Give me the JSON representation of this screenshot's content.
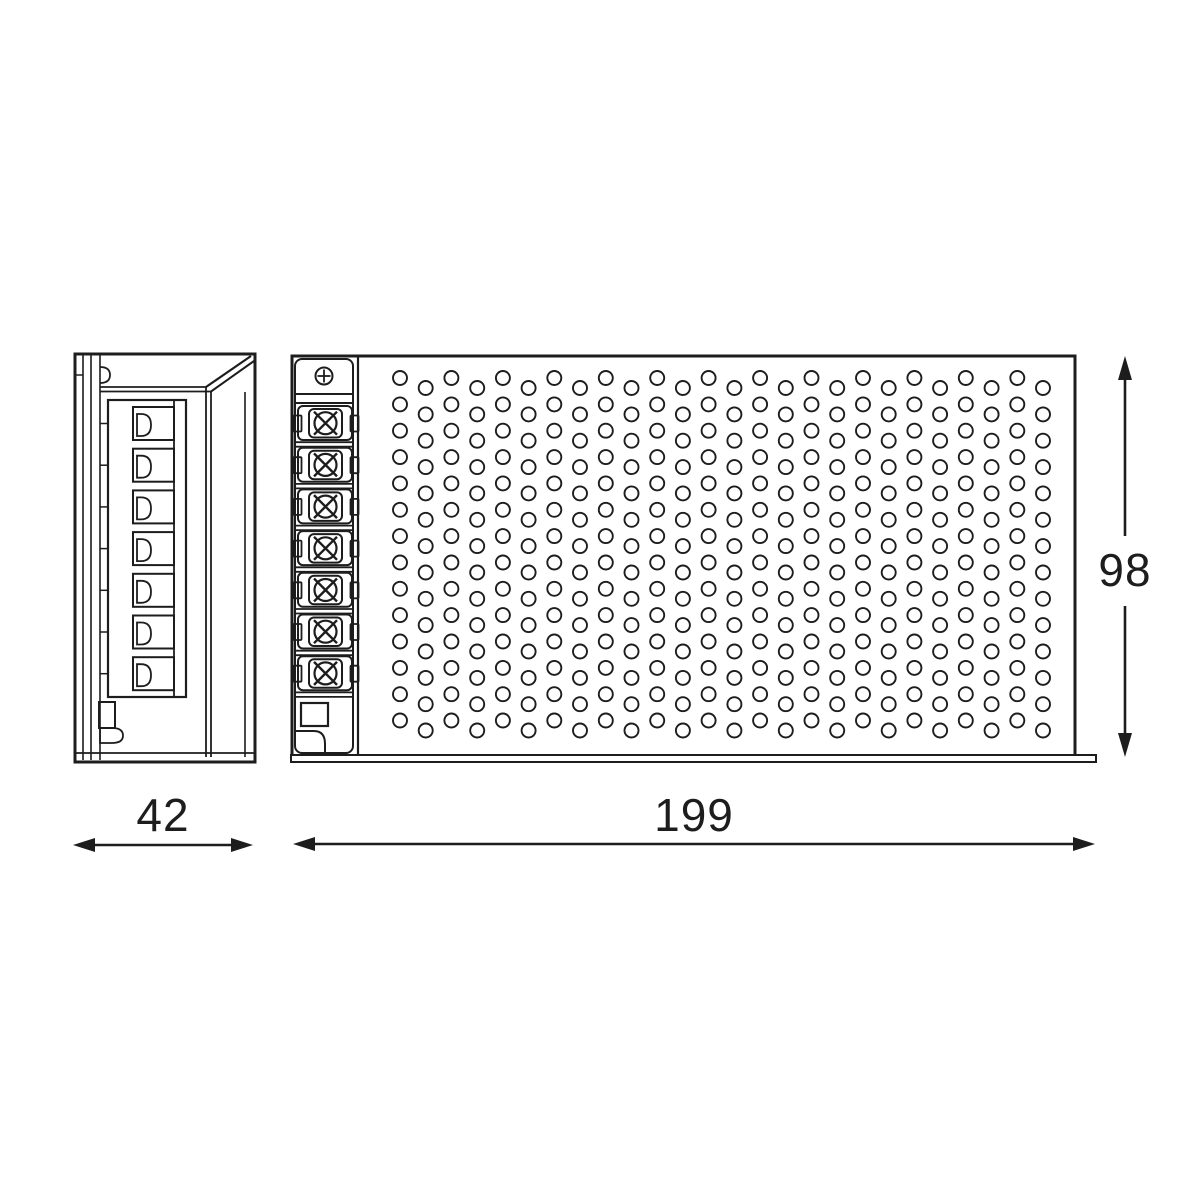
{
  "page": {
    "background": "#ffffff"
  },
  "drawing": {
    "kind": "technical dimension drawing",
    "subject": "perforated metal enclosure (power supply / LED driver)",
    "line_color": "#1d1d1d",
    "views": {
      "side": {
        "name": "side view",
        "terminal_cells": 7
      },
      "front": {
        "name": "front view",
        "terminal_screws": 7,
        "perforation": {
          "columns": 26,
          "rows": 14
        }
      }
    },
    "dimensions": {
      "side_width": {
        "value": "42"
      },
      "front_width": {
        "value": "199"
      },
      "front_height": {
        "value": "98"
      }
    }
  }
}
